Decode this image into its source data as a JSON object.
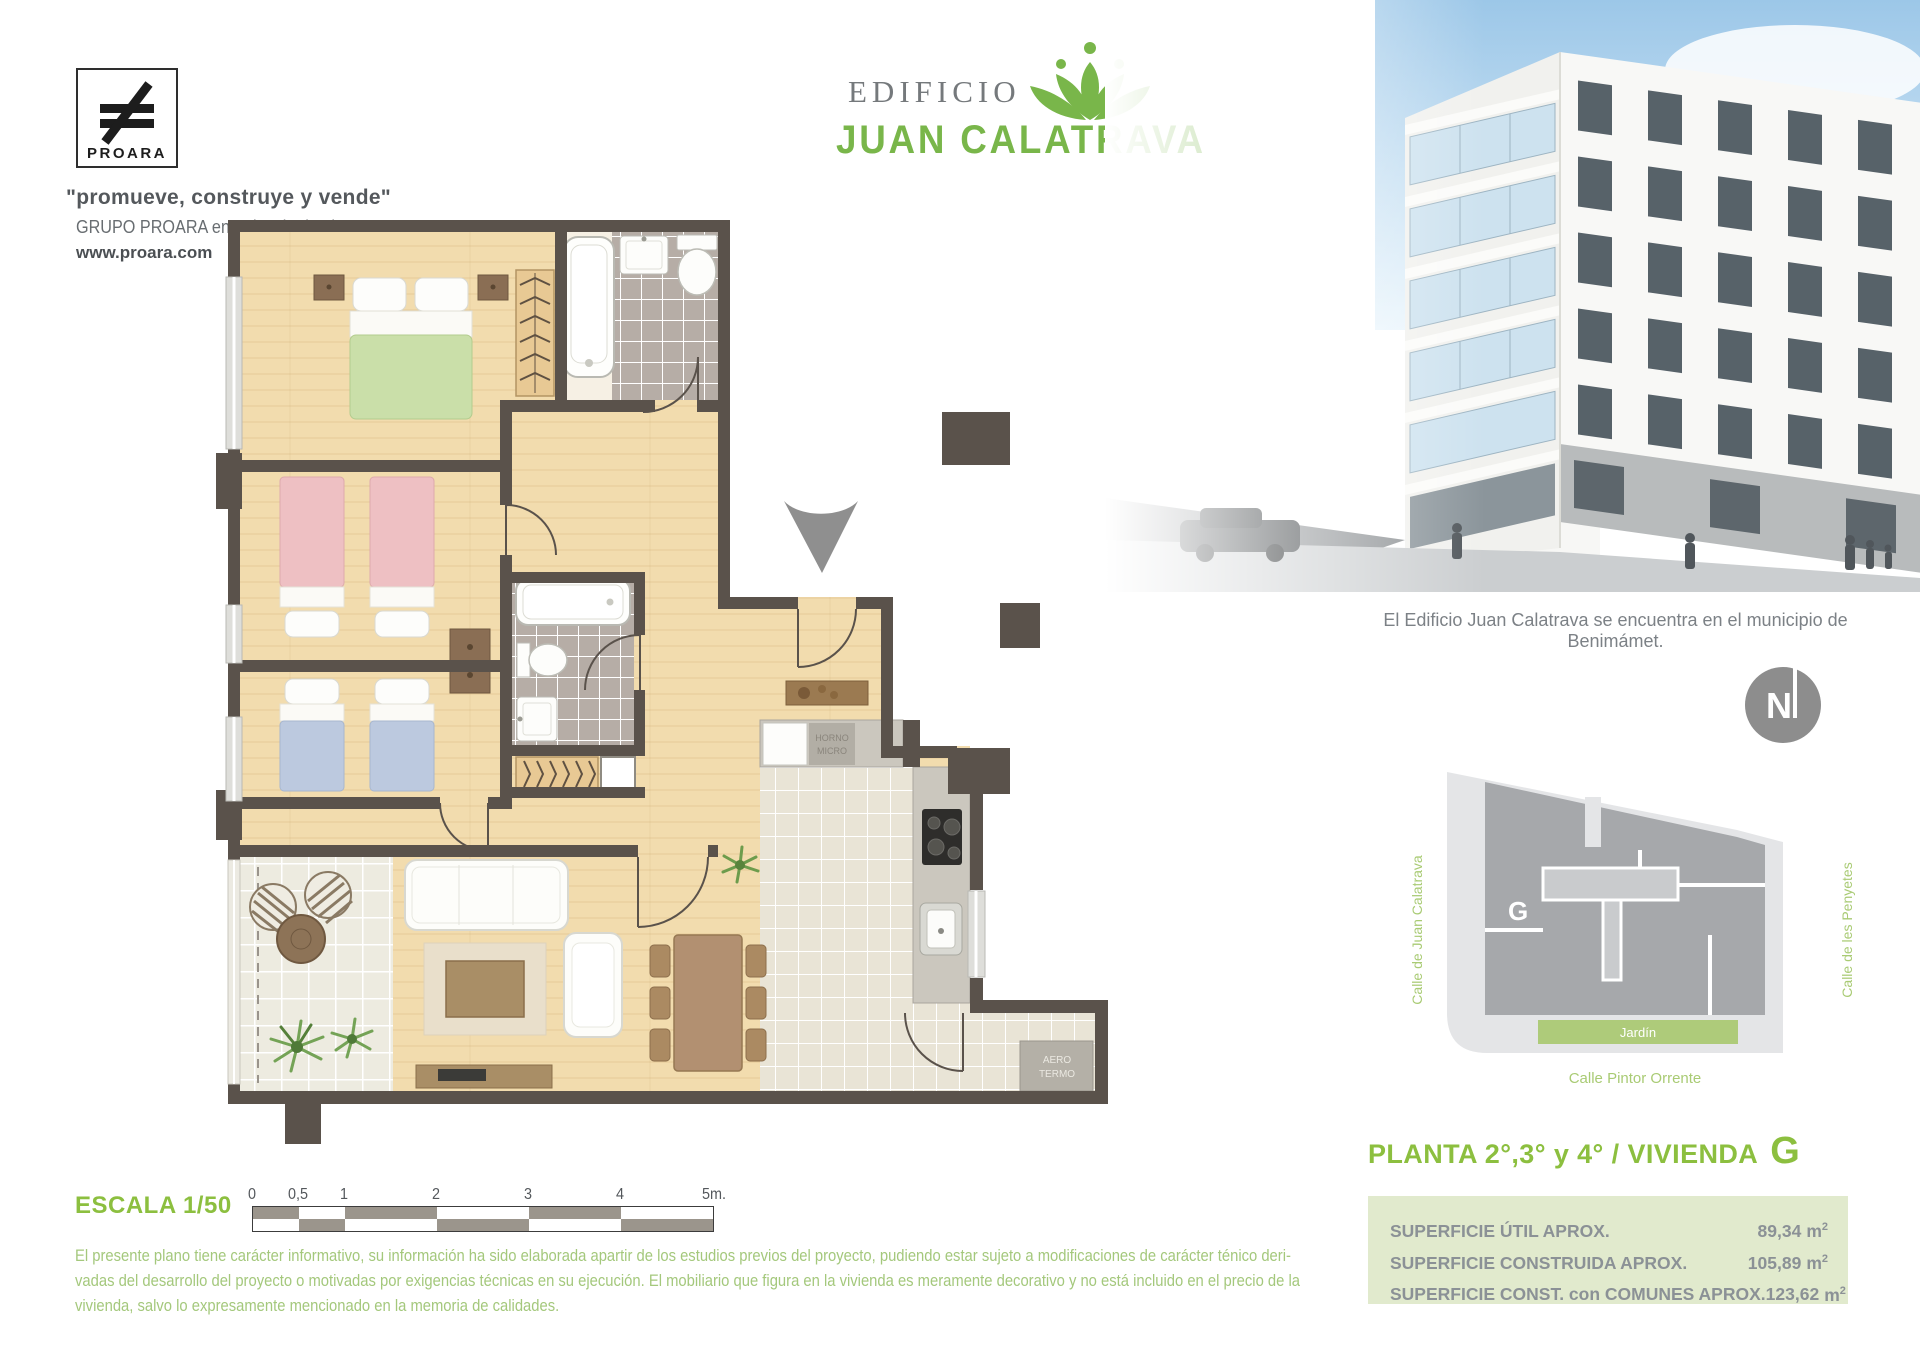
{
  "branding": {
    "logo_text": "PROARA",
    "tagline": "\"promueve, construye y vende\"",
    "subtitle": "GRUPO PROARA en Valencia desde 1969",
    "website": "www.proara.com"
  },
  "header": {
    "building_label": "EDIFICIO",
    "building_name": "JUAN CALATRAVA"
  },
  "photo": {
    "caption": "El Edificio Juan Calatrava se encuentra en el municipio de Benimámet."
  },
  "compass": {
    "north_label": "N"
  },
  "sitemap": {
    "unit_letter": "G",
    "garden_label": "Jardín",
    "street_left": "Calle de Juan Calatrava",
    "street_right": "Calle de les Penyetes",
    "street_bottom": "Calle Pintor Orrente"
  },
  "plan_info": {
    "title_prefix": "PLANTA 2°,3° y 4° / VIVIENDA",
    "unit_letter": "G",
    "unit": "m",
    "unit_sup": "2",
    "areas": [
      {
        "label": "SUPERFICIE ÚTIL APROX.",
        "value": "89,34"
      },
      {
        "label": "SUPERFICIE CONSTRUIDA APROX.",
        "value": "105,89"
      },
      {
        "label": "SUPERFICIE CONST. con COMUNES APROX.",
        "value": "123,62"
      }
    ]
  },
  "scale": {
    "label": "ESCALA 1/50",
    "ticks": [
      "0",
      "0,5",
      "1",
      "2",
      "3",
      "4",
      "5m."
    ]
  },
  "floorplan": {
    "oven_top": "HORNO",
    "oven_bottom": "MICRO",
    "heater_top": "AERO",
    "heater_bottom": "TERMO"
  },
  "disclaimer": {
    "lines": [
      "El presente plano tiene carácter informativo, su información ha sido elaborada apartir de los estudios previos del proyecto, pudiendo estar sujeto a modificaciones de carácter ténico deri-",
      "vadas del desarrollo del proyecto o motivadas por exigencias técnicas en su ejecución. El mobiliario que figura en la vivienda es meramente decorativo y no está incluido en el precio de la",
      "vivienda, salvo lo expresamente mencionado en la memoria de calidades."
    ]
  },
  "colors": {
    "brand_green": "#79b64a",
    "heading_green": "#8cbf3f",
    "pale_green_text": "#a4c87c",
    "areas_box_bg": "#e1eacd",
    "wall": "#5a524b",
    "gray_text": "#7c8186"
  }
}
